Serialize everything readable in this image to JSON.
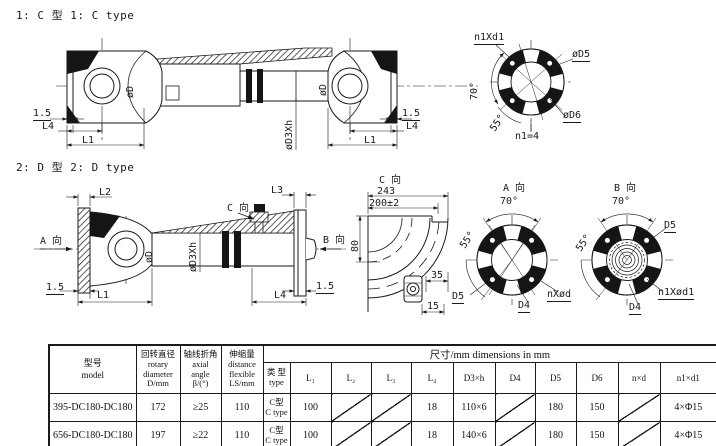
{
  "colors": {
    "background": "#ffffff",
    "line": "#1a1a1a",
    "fill_black": "#151515"
  },
  "c_type": {
    "section_label": "1: C 型 1: C type",
    "labels": {
      "od": "øD",
      "od3h": "øD3Xh",
      "t": "1.5",
      "l4": "L4",
      "l1": "L1"
    },
    "flange": {
      "bolts": "n1Xd1",
      "d5": "øD5",
      "d6": "øD6",
      "a70": "70°",
      "a55": "55°",
      "count": "n1=4"
    }
  },
  "d_type": {
    "section_label": "2: D 型 2: D type",
    "labels": {
      "od": "øD",
      "od3h": "øD3Xh",
      "t": "1.5",
      "l1": "L1",
      "l2": "L2",
      "l3": "L3",
      "l4": "L4",
      "view_a": "A 向",
      "view_b": "B 向",
      "view_c": "C 向"
    },
    "c_view": {
      "title": "C 向",
      "d243": "243",
      "d200": "200±2",
      "d80": "80",
      "d35": "35",
      "d15": "15"
    },
    "a_view": {
      "title": "A 向",
      "a70": "70°",
      "a55": "55°",
      "d5": "D5",
      "d4": "D4",
      "nd": "nXød"
    },
    "b_view": {
      "title": "B 向",
      "a70": "70°",
      "a55": "55°",
      "d5": "D5",
      "d4": "D4",
      "nd": "n1Xød1"
    }
  },
  "table": {
    "span_header": "尺寸/mm  dimensions in mm",
    "headers": {
      "model": [
        "型号",
        "model"
      ],
      "rotary": [
        "回转直径",
        "rotary",
        "diameter",
        "D/mm"
      ],
      "axial": [
        "轴线折角",
        "axial",
        "angle",
        "β/(°)"
      ],
      "flexible": [
        "伸缩量",
        "distance",
        "flexible",
        "LS/mm"
      ],
      "type": [
        "类 型",
        "type"
      ],
      "dims": [
        "L₁",
        "L₂",
        "L₃",
        "L₄",
        "D3×h",
        "D4",
        "D5",
        "D6",
        "n×d",
        "n1×d1"
      ]
    },
    "rows": [
      {
        "model": "395-DC180-DC180",
        "rotary": "172",
        "axial": "≥25",
        "flexible": "110",
        "type_cn": "C型",
        "type_en": "C type",
        "values": [
          "100",
          "",
          "",
          "18",
          "110×6",
          "",
          "180",
          "150",
          "",
          "4×Φ15"
        ]
      },
      {
        "model": "656-DC180-DC180",
        "rotary": "197",
        "axial": "≥22",
        "flexible": "110",
        "type_cn": "C型",
        "type_en": "C type",
        "values": [
          "100",
          "",
          "",
          "18",
          "140×6",
          "",
          "180",
          "150",
          "",
          "4×Φ15"
        ]
      }
    ]
  }
}
